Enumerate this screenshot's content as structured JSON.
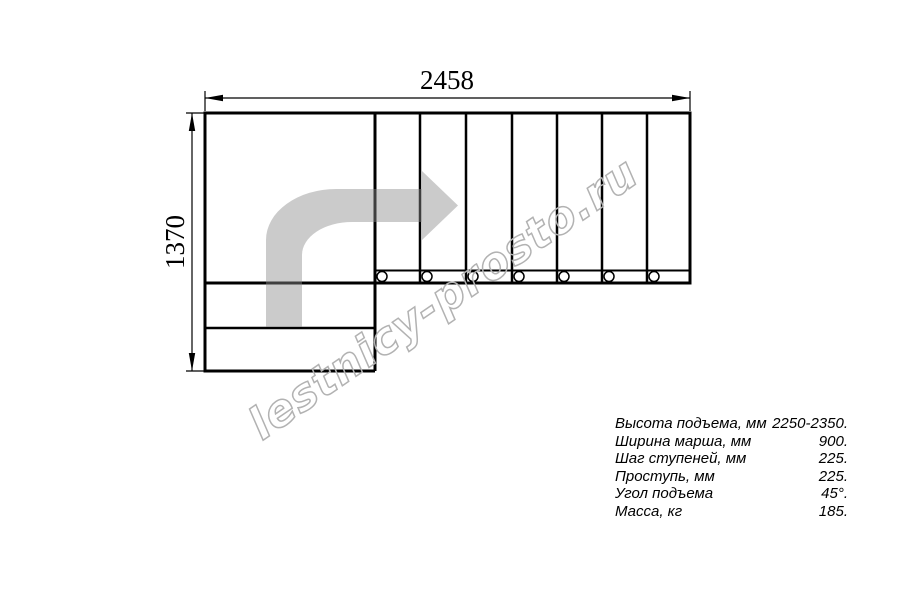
{
  "page": {
    "background": "#ffffff"
  },
  "drawing": {
    "dimension_width": "2458",
    "dimension_height": "1370",
    "treads_in_run": 7,
    "lower_steps": 2,
    "line_color": "#000000",
    "arrow_color": "#c8c8c8"
  },
  "watermark": {
    "text": "lestnicy-prosto.ru",
    "color": "#b2b2b2"
  },
  "specs": {
    "rows": [
      {
        "label": "Высота подъема, мм",
        "value": "2250-2350."
      },
      {
        "label": "Ширина марша, мм",
        "value": "900."
      },
      {
        "label": "Шаг ступеней, мм",
        "value": "225."
      },
      {
        "label": "Проступь, мм",
        "value": "225."
      },
      {
        "label": "Угол подъема",
        "value": "45°."
      },
      {
        "label": "Масса, кг",
        "value": "185."
      }
    ]
  }
}
